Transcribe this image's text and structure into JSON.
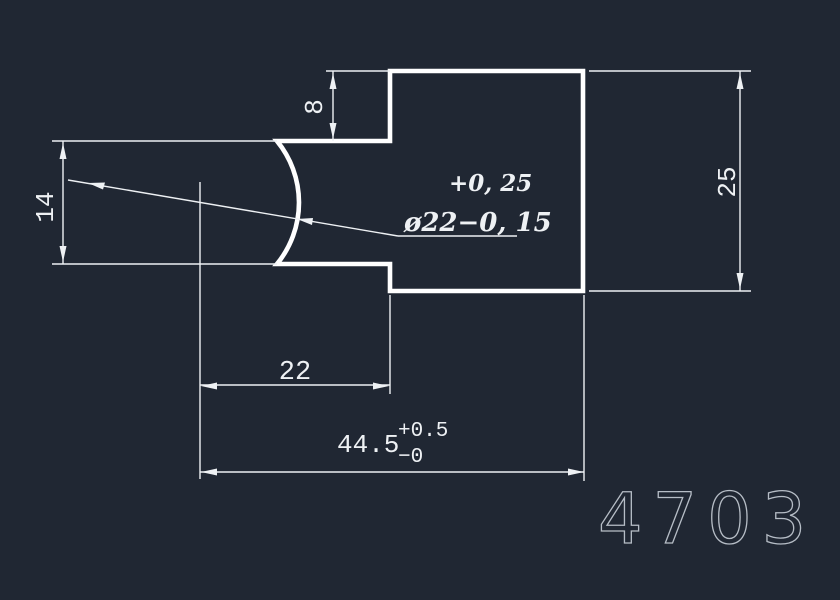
{
  "drawing": {
    "part_number": "4703",
    "colors": {
      "background": "#202733",
      "outline": "#ffffff",
      "dimension": "#eef1f4",
      "part_number": "#b6bdc6"
    },
    "dimensions": {
      "step_height": "8",
      "neck_height": "14",
      "body_height": "25",
      "neck_length": "22",
      "overall_length": "44.5",
      "overall_upper_tol": "+0.5",
      "overall_lower_tol": "−0",
      "sphere_upper_tol": "+0, 25",
      "sphere_diameter": "ø22−0, 15"
    }
  }
}
